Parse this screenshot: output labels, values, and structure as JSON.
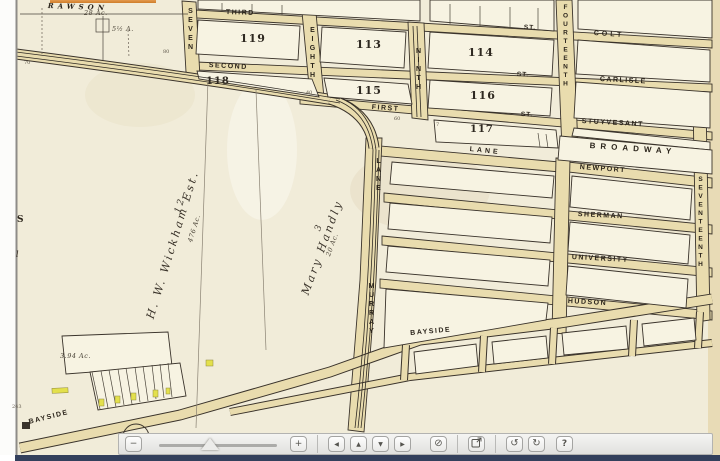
{
  "viewer": {
    "colors": {
      "paper": "#f1ecd9",
      "street_fill": "#e9dcae",
      "map_line": "#3a332b",
      "accent_orange": "#d98a35",
      "footer_bar": "#33405c",
      "toolbar_bg": "#ececea",
      "lot_highlight_yellow": "#e3e04c"
    }
  },
  "map": {
    "streets": {
      "rawson": "RAWSON",
      "third": "THIRD",
      "second": "SECOND",
      "first": "FIRST",
      "st_abbrev": "ST.",
      "colt": "COLT",
      "carlisle": "CARLISLE",
      "stuyvesant": "STUYVESANT",
      "broadway": "BROADWAY",
      "lane": "LANE",
      "newport": "NEWPORT",
      "sherman": "SHERMAN",
      "university": "UNIVERSITY",
      "hudson": "HUDSON",
      "bayside": "BAYSIDE",
      "seven": "SEVEN",
      "eighth": "EIGHTH",
      "ninth": "NINTH",
      "fourteenth": "FOURTEENTH",
      "seventeenth": "SEVENTEENTH",
      "murray": "MURRAY",
      "lane_v": "LANE"
    },
    "blocks": {
      "b119": "119",
      "b118": "118",
      "b113": "113",
      "b115": "115",
      "b114": "114",
      "b116": "116",
      "b117": "117"
    },
    "parcels": {
      "wickham_name": "H. W. Wickham Est.",
      "wickham_no": "12",
      "wickham_acreage": "476 Ac.",
      "handly_name": "Mary Handly",
      "handly_no": "3",
      "handly_acreage": "20 Ac.",
      "rawson_acreage": "28 Ac.",
      "small_acreage": "5½ A.",
      "shore_lot_acreage": "3.94 Ac."
    },
    "tiny": {
      "n80": "80",
      "n70": "70",
      "n40": "40",
      "n60": "60",
      "n7": "7",
      "n243": "243",
      "edge_s": "S",
      "edge_l": "l"
    }
  },
  "toolbar": {
    "zoom_out": "−",
    "zoom_in": "+",
    "pan_left": "◀",
    "pan_up": "▲",
    "pan_down": "▼",
    "pan_right": "▶",
    "reset": "⊘",
    "rotate_ccw": "↺",
    "rotate_cw": "↻",
    "help": "?"
  }
}
